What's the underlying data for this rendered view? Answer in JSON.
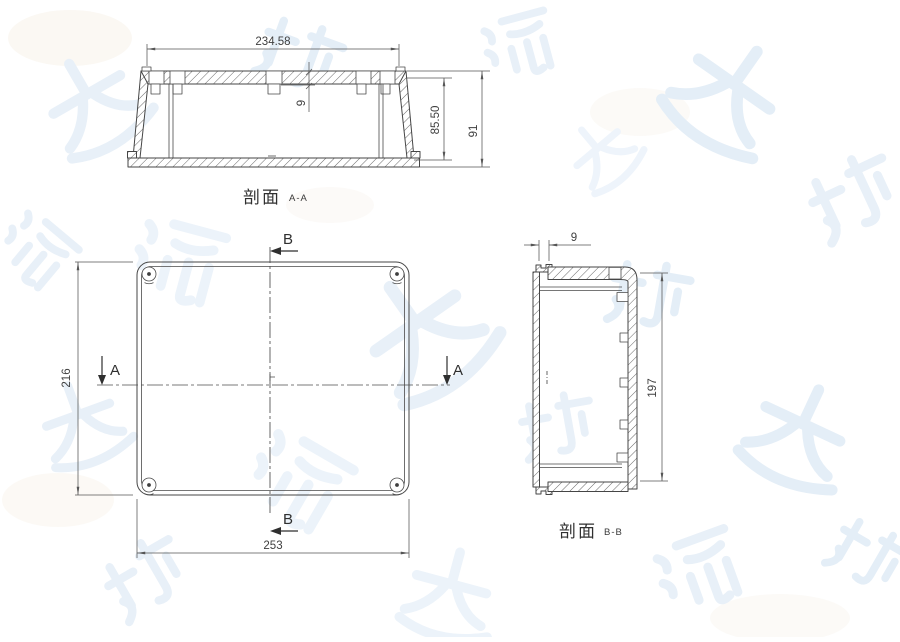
{
  "section_aa": {
    "label": "剖面",
    "label_detail": "A-A",
    "dim_width": "234.58",
    "dim_tab_depth": "9",
    "dim_inner_height": "85.50",
    "dim_outer_height": "91"
  },
  "plan_view": {
    "dim_height": "216",
    "dim_width": "253",
    "section_mark_a": "A",
    "section_mark_b": "B"
  },
  "section_bb": {
    "label": "剖面",
    "label_detail": "B-B",
    "dim_flange_width": "9",
    "dim_inner_height": "197"
  },
  "colors": {
    "line": "#454545",
    "dimension": "#555555",
    "watermark_blue": "#e8f0f8",
    "watermark_warm": "#f7f2e9"
  }
}
